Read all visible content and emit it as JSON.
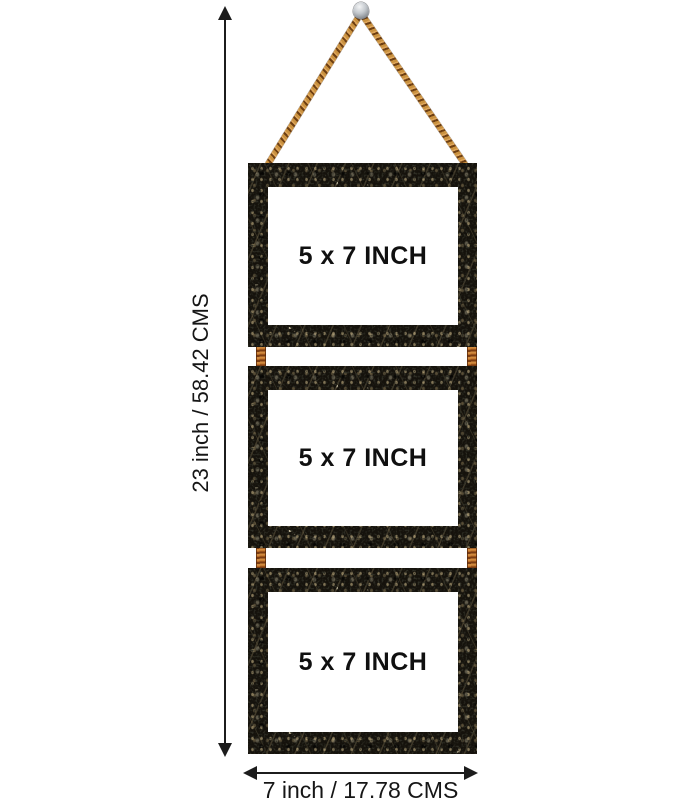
{
  "frames": [
    {
      "label": "5 x 7 INCH"
    },
    {
      "label": "5 x 7 INCH"
    },
    {
      "label": "5 x 7 INCH"
    }
  ],
  "dimensions": {
    "height_label": "23 inch / 58.42 CMS",
    "width_label": "7 inch / 17.78 CMS"
  },
  "icons": {
    "arrowhead_up": "triangle-up",
    "arrowhead_down": "triangle-down",
    "arrowhead_left": "triangle-left",
    "arrowhead_right": "triangle-right",
    "pin": "round-head-wall-pin",
    "rope": "twisted-jute-rope"
  },
  "colors": {
    "background": "#ffffff",
    "dimension_lines": "#1c1c1c",
    "text": "#161616",
    "frame_marble_base": "#15120c",
    "frame_marble_vein": "#cdb27c",
    "rope_light": "#c9913f",
    "rope_dark": "#6e3f12",
    "pin_silver": "#b9bec4",
    "frame_window": "#ffffff"
  }
}
